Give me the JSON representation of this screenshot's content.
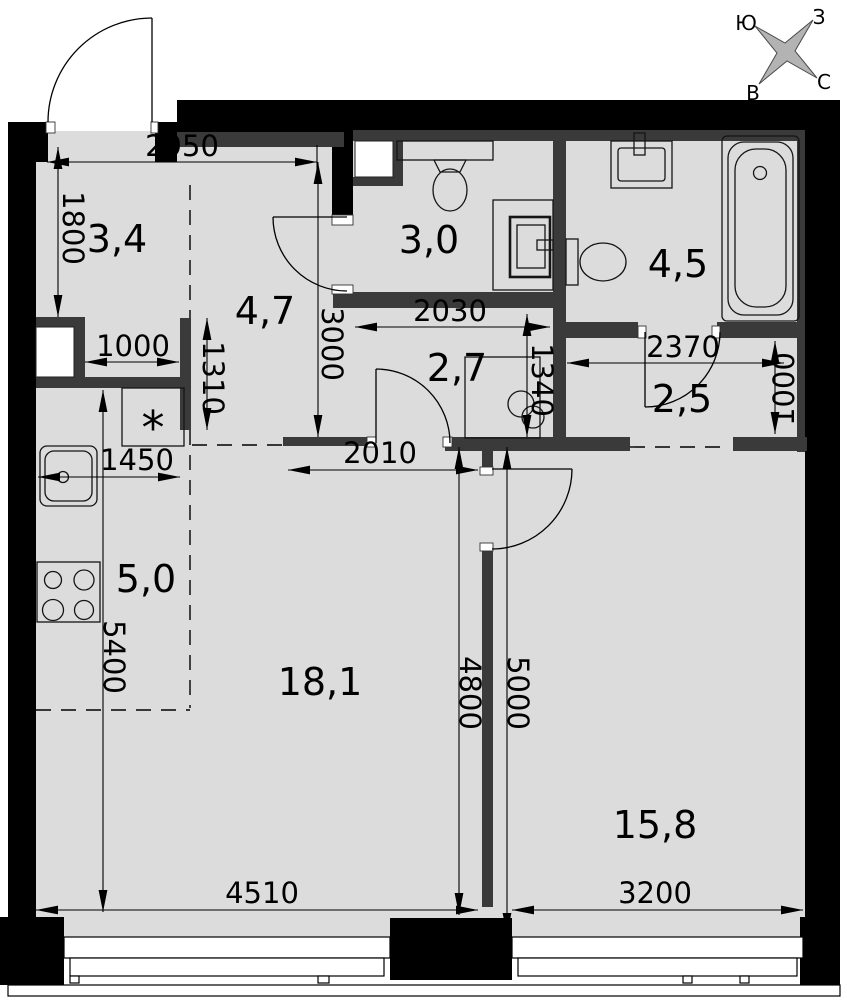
{
  "plan": {
    "title": "apartment floor plan",
    "compass": {
      "south": "Ю",
      "west": "З",
      "east": "В",
      "north": "С"
    },
    "rooms": {
      "hallway": "3,4",
      "corridor": "4,7",
      "wc": "3,0",
      "bathroom": "4,5",
      "hall": "2,7",
      "wardrobe": "2,5",
      "kitchen": "5,0",
      "living_room": "18,1",
      "bedroom": "15,8"
    },
    "dimensions": {
      "entry_width": "2950",
      "hallway_depth": "1800",
      "niche_width": "1000",
      "niche_depth": "1310",
      "kitchen_width": "1450",
      "corridor_depth": "3000",
      "wc_width": "2030",
      "hall_depth": "1340",
      "hall_width": "2010",
      "wardrobe_width": "2370",
      "wardrobe_depth": "1000",
      "living_depth": "4800",
      "bedroom_depth": "5000",
      "kitchen_depth": "5400",
      "living_width": "4510",
      "bedroom_width": "3200"
    },
    "symbols": {
      "fridge": "*"
    },
    "colors": {
      "floor": "#dcdcdc",
      "outer_walls": "#000000",
      "partitions": "#3a3a3a",
      "compass_fill": "#b3b3b3"
    }
  }
}
